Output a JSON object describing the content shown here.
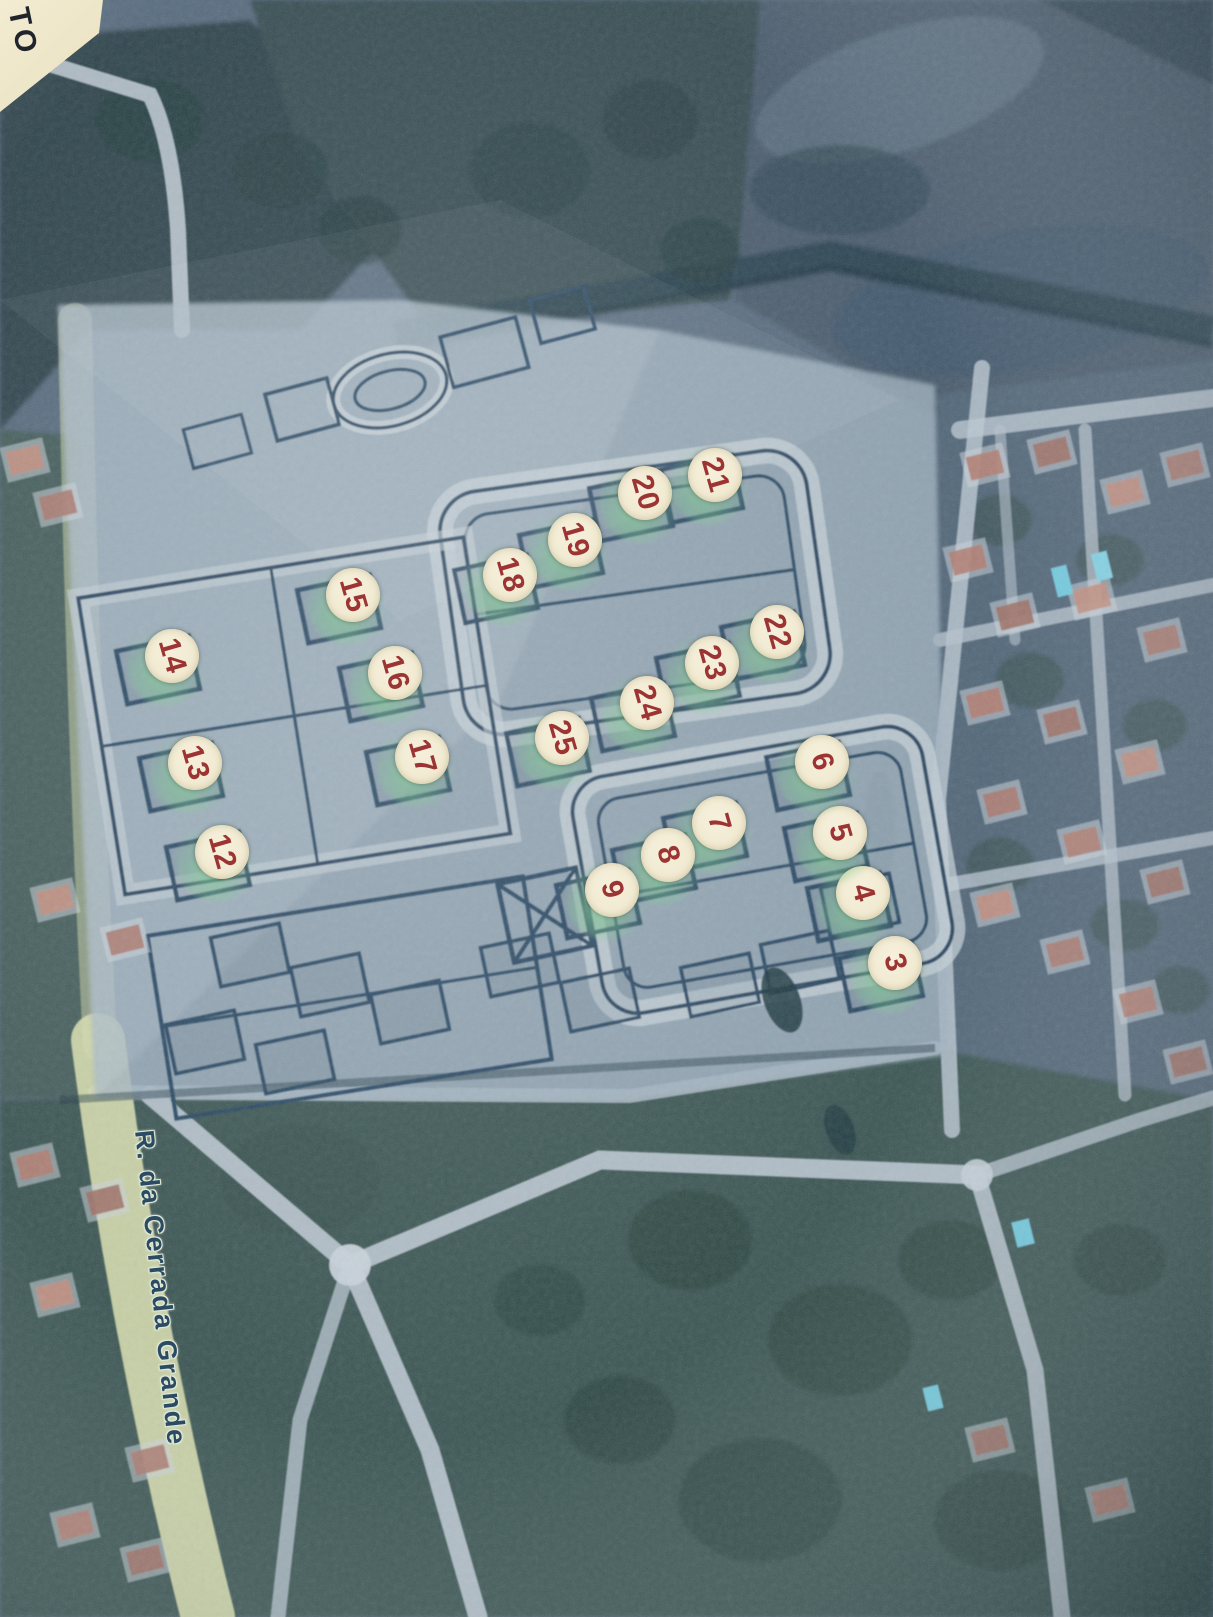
{
  "map": {
    "street_label": "R. da Cerrada Grande",
    "corner_note_text": "TO",
    "markers": [
      {
        "n": 3,
        "x": 895,
        "y": 963
      },
      {
        "n": 4,
        "x": 863,
        "y": 893
      },
      {
        "n": 5,
        "x": 840,
        "y": 833
      },
      {
        "n": 6,
        "x": 822,
        "y": 762
      },
      {
        "n": 7,
        "x": 719,
        "y": 823
      },
      {
        "n": 8,
        "x": 668,
        "y": 855
      },
      {
        "n": 9,
        "x": 612,
        "y": 890
      },
      {
        "n": 12,
        "x": 222,
        "y": 852
      },
      {
        "n": 13,
        "x": 195,
        "y": 763
      },
      {
        "n": 14,
        "x": 172,
        "y": 656
      },
      {
        "n": 15,
        "x": 353,
        "y": 595
      },
      {
        "n": 16,
        "x": 395,
        "y": 673
      },
      {
        "n": 17,
        "x": 422,
        "y": 757
      },
      {
        "n": 18,
        "x": 510,
        "y": 575
      },
      {
        "n": 19,
        "x": 575,
        "y": 540
      },
      {
        "n": 20,
        "x": 645,
        "y": 493
      },
      {
        "n": 21,
        "x": 715,
        "y": 475
      },
      {
        "n": 22,
        "x": 777,
        "y": 632
      },
      {
        "n": 23,
        "x": 712,
        "y": 663
      },
      {
        "n": 24,
        "x": 647,
        "y": 703
      },
      {
        "n": 25,
        "x": 562,
        "y": 738
      }
    ],
    "street_label_pos": {
      "x": 160,
      "y": 1288,
      "rotation_deg": 84
    },
    "colors": {
      "marker_fill": "#f2ebd3",
      "marker_number": "#9c3433",
      "marker_glow": "#86d296",
      "road_highlight": "#d8dfae",
      "plan_line": "#24435e",
      "label_text": "#2b4a63",
      "label_halo": "#dfe8d4"
    }
  }
}
